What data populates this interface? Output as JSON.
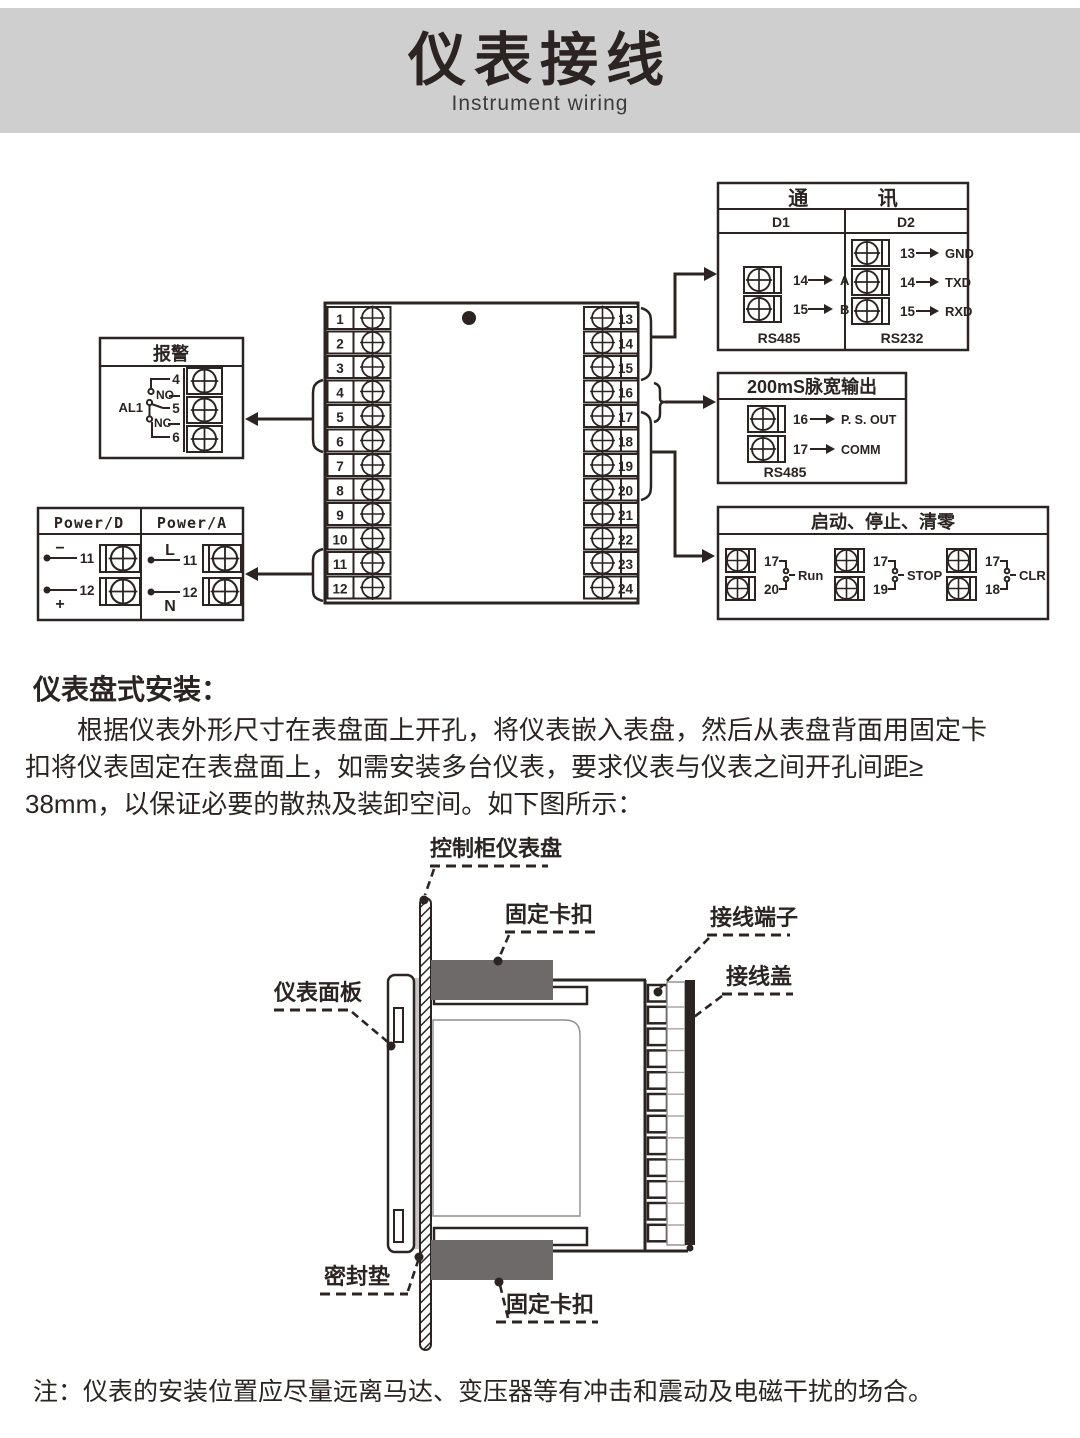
{
  "header": {
    "title": "仪表接线",
    "subtitle": "Instrument wiring"
  },
  "wiring": {
    "comm": {
      "title": "通 讯",
      "d1": {
        "label": "D1",
        "rows": [
          {
            "num": "14",
            "target": "A"
          },
          {
            "num": "15",
            "target": "B"
          }
        ],
        "bus": "RS485"
      },
      "d2": {
        "label": "D2",
        "rows": [
          {
            "num": "13",
            "target": "GND"
          },
          {
            "num": "14",
            "target": "TXD"
          },
          {
            "num": "15",
            "target": "RXD"
          }
        ],
        "bus": "RS232"
      }
    },
    "alarm": {
      "title": "报警",
      "relay": "AL1",
      "no": "NO",
      "nc": "NC",
      "terminals": [
        "4",
        "5",
        "6"
      ]
    },
    "pulse": {
      "title": "200mS脉宽输出",
      "rows": [
        {
          "num": "16",
          "target": "P. S. OUT"
        },
        {
          "num": "17",
          "target": "COMM"
        }
      ],
      "bus": "RS485"
    },
    "power": {
      "d_label": "Power/D",
      "a_label": "Power/A",
      "d": {
        "minus": "−",
        "plus": "+",
        "t1": "11",
        "t2": "12"
      },
      "a": {
        "l": "L",
        "n": "N",
        "t1": "11",
        "t2": "12"
      }
    },
    "control": {
      "title": "启动、停止、清零",
      "groups": [
        {
          "t1": "17",
          "t2": "20",
          "label": "Run"
        },
        {
          "t1": "17",
          "t2": "19",
          "label": "STOP"
        },
        {
          "t1": "17",
          "t2": "18",
          "label": "CLR"
        }
      ]
    },
    "main_block": {
      "left": [
        "1",
        "2",
        "3",
        "4",
        "5",
        "6",
        "7",
        "8",
        "9",
        "10",
        "11",
        "12"
      ],
      "right": [
        "13",
        "14",
        "15",
        "16",
        "17",
        "18",
        "19",
        "20",
        "21",
        "22",
        "23",
        "24"
      ]
    }
  },
  "install_section": {
    "heading": "仪表盘式安装：",
    "paragraph_lines": [
      "根据仪表外形尺寸在表盘面上开孔，将仪表嵌入表盘，然后从表盘背面用固定卡",
      "扣将仪表固定在表盘面上，如需安装多台仪表，要求仪表与仪表之间开孔间距≥",
      "38mm，以保证必要的散热及装卸空间。如下图所示："
    ]
  },
  "install_diagram": {
    "labels": {
      "panel": "控制柜仪表盘",
      "clip_top": "固定卡扣",
      "terminal": "接线端子",
      "cover": "接线盖",
      "faceplate": "仪表面板",
      "gasket": "密封垫",
      "clip_bottom": "固定卡扣"
    }
  },
  "note": "注：仪表的安装位置应尽量远离马达、变压器等有冲击和震动及电磁干扰的场合。",
  "colors": {
    "header_bg": "#d0cfcf",
    "ink": "#2b2422",
    "clip_gray": "#6e6a6a",
    "gasket_gray": "#c9c6c6"
  }
}
